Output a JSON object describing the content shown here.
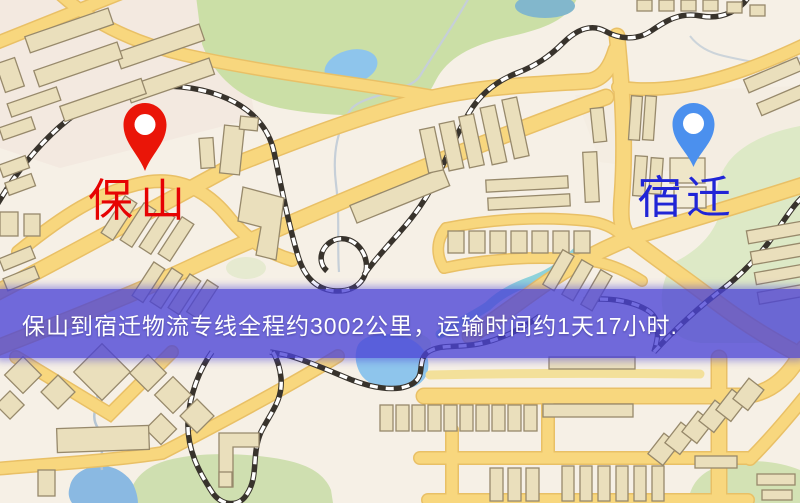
{
  "map": {
    "markers": [
      {
        "id": "origin",
        "label": "保山",
        "label_color": "#e60303",
        "pin_color": "#ea1508"
      },
      {
        "id": "destination",
        "label": "宿迁",
        "label_color": "#2025d6",
        "pin_color": "#4b90ee"
      }
    ],
    "banner": {
      "text": "保山到宿迁物流专线全程约3002公里，运输时间约1天17小时.",
      "background": "#4a42d6",
      "text_color": "#ffffff"
    }
  },
  "palette": {
    "land": "#f6f0e6",
    "road_fill": "#f8d77e",
    "road_casing": "#e9c066",
    "minor_road": "#f3e09a",
    "green_park": "#cbdfa6",
    "water": "#8ec5ec",
    "building_fill": "#eadfbc",
    "building_outline": "#97896b",
    "railway_dark": "#38332c",
    "railway_light": "#ffffff"
  }
}
